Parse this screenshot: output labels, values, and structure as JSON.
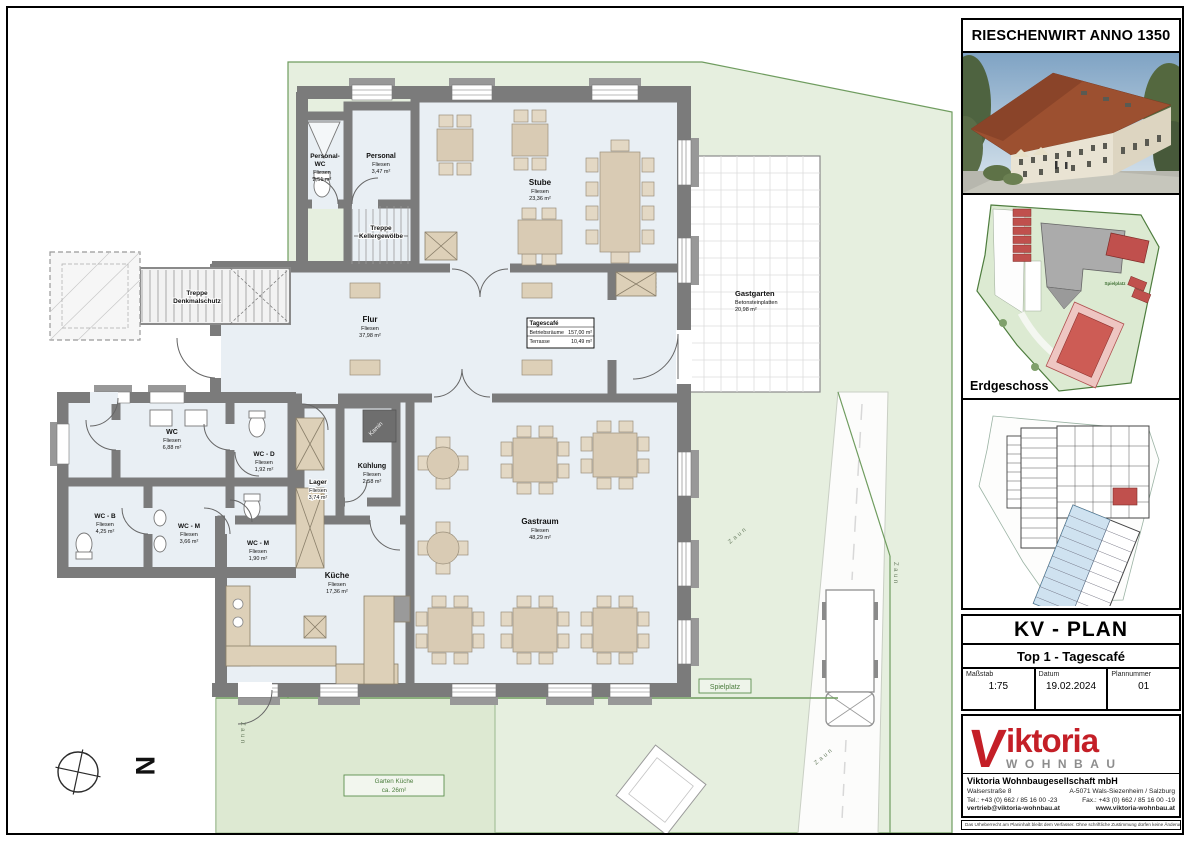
{
  "colors": {
    "accent_red": "#c41f27",
    "wall_gray": "#7b7b7b",
    "room_fill": "#e9eff4",
    "site_green": "#e6efdf",
    "furniture_beige": "#d9cbb4"
  },
  "plan": {
    "rooms": {
      "personal_wc": {
        "n1": "Personal-",
        "n2": "WC",
        "mat": "Fliesen",
        "area": "2,51 m²"
      },
      "personal": {
        "name": "Personal",
        "mat": "Fliesen",
        "area": "3,47 m²"
      },
      "stube": {
        "name": "Stube",
        "mat": "Fliesen",
        "area": "23,36 m²"
      },
      "flur": {
        "name": "Flur",
        "mat": "Fliesen",
        "area": "37,98 m²"
      },
      "wc": {
        "name": "WC",
        "mat": "Fliesen",
        "area": "6,88 m²"
      },
      "wc_d": {
        "name": "WC - D",
        "mat": "Fliesen",
        "area": "1,92 m²"
      },
      "wc_b": {
        "name": "WC - B",
        "mat": "Fliesen",
        "area": "4,25 m²"
      },
      "wc_m": {
        "name": "WC - M",
        "mat": "Fliesen",
        "area": "3,66 m²"
      },
      "wc_m2": {
        "name": "WC - M",
        "mat": "Fliesen",
        "area": "1,90 m²"
      },
      "lager": {
        "name": "Lager",
        "mat": "Fliesen",
        "area": "3,74 m²"
      },
      "kuehlung": {
        "name": "Kühlung",
        "mat": "Fliesen",
        "area": "2,58 m²"
      },
      "kueche": {
        "name": "Küche",
        "mat": "Fliesen",
        "area": "17,36 m²"
      },
      "gastraum": {
        "name": "Gastraum",
        "mat": "Fliesen",
        "area": "48,29 m²"
      },
      "gastgarten": {
        "name": "Gastgarten",
        "mat": "Betonsteinplatten",
        "area": "20,98 m²"
      },
      "treppe_keller": {
        "l1": "Treppe",
        "l2": "Kellergewölbe"
      },
      "treppe_denkmal": {
        "l1": "Treppe",
        "l2": "Denkmalschutz"
      }
    },
    "info_box": {
      "title": "Tagescafé",
      "row1_label": "Betriebsräume",
      "row1_value": "157,00 m²",
      "row2_label": "Terrasse",
      "row2_value": "10,49 m²"
    },
    "site_labels": {
      "spielplatz": "Spielplatz",
      "garten1": "Garten Küche",
      "garten2": "ca. 26m²",
      "zaun": "Zaun",
      "kamin": "Kamin",
      "north": "N"
    }
  },
  "panel": {
    "project_title": "RIESCHENWIRT ANNO 1350",
    "floor_label": "Erdgeschoss",
    "plan_type": "KV - PLAN",
    "plan_subtitle": "Top 1 - Tagescafé",
    "meta": {
      "scale_label": "Maßstab",
      "scale": "1:75",
      "date_label": "Datum",
      "date": "19.02.2024",
      "number_label": "Plannummer",
      "number": "01"
    },
    "logo": {
      "v": "V",
      "name": "iktoria",
      "wordmark": "WOHNBAU"
    },
    "company": {
      "name": "Viktoria Wohnbaugesellschaft mbH",
      "address1": "Walserstraße 8",
      "address2": "A-5071 Wals-Siezenheim / Salzburg",
      "tel": "Tel.: +43 (0) 662 / 85 16 00 -23",
      "fax": "Fax.: +43 (0) 662 / 85 16 00 -19",
      "email": "vertrieb@viktoria-wohnbau.at",
      "web": "www.viktoria-wohnbau.at",
      "fineprint": "Das Urheberrecht am Planinhalt bleibt dem Verfasser. Ohne schriftliche Zustimmung dürfen keine Änderungen vorgenommen werden."
    }
  }
}
